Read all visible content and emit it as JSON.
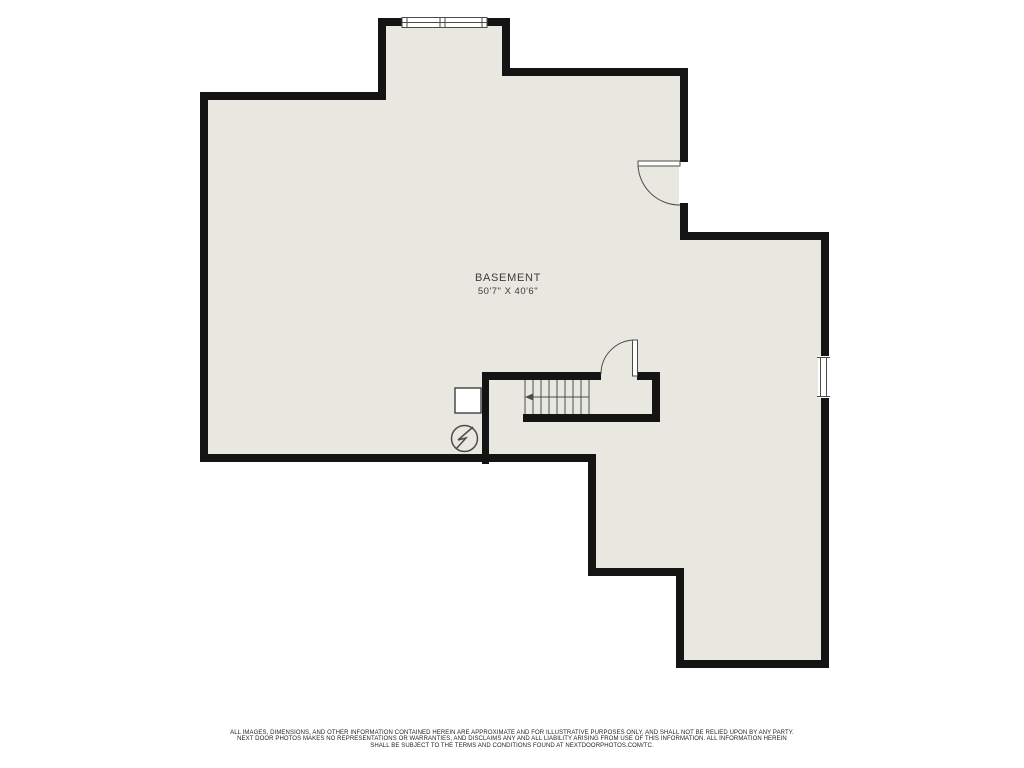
{
  "colors": {
    "background": "#ffffff",
    "floor": "#e9e8e0",
    "wall": "#141414",
    "line": "#4b4b4b",
    "label_text": "#3b3b3b",
    "disclaimer_text": "#1f1f1f"
  },
  "room": {
    "name": "BASEMENT",
    "dimensions": "50'7\" X 40'6\""
  },
  "disclaimer": {
    "line1": "ALL IMAGES, DIMENSIONS, AND OTHER INFORMATION CONTAINED HEREIN ARE APPROXIMATE AND FOR ILLUSTRATIVE PURPOSES ONLY, AND SHALL NOT BE RELIED UPON BY ANY PARTY.",
    "line2": "NEXT DOOR PHOTOS MAKES NO REPRESENTATIONS OR WARRANTIES, AND DISCLAIMS ANY AND ALL LIABILITY ARISING FROM USE OF THIS INFORMATION. ALL INFORMATION HEREIN",
    "line3": "SHALL BE SUBJECT TO THE TERMS AND CONDITIONS FOUND AT NEXTDOORPHOTOS.COM/TC."
  }
}
